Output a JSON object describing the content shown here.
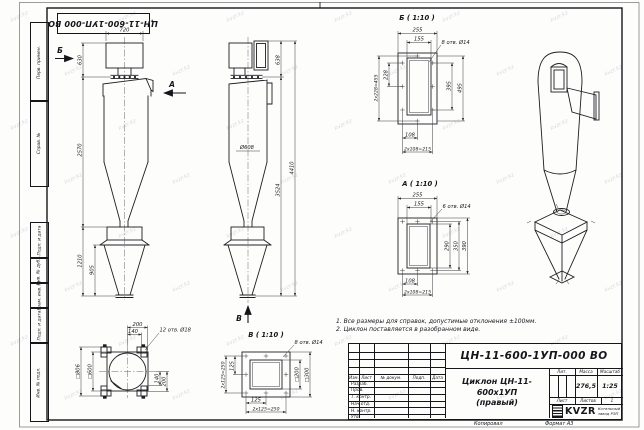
{
  "frame": {
    "inverted_title": "ЦН-11-600-1УП-000 ВО",
    "columns_top": [
      "Перв. примен.",
      "Справ. №"
    ],
    "columns_bottom": [
      "Подп. и дата",
      "Инв. № дубл.",
      "Взам. инв. №",
      "Подп. и дата",
      "Инв. № подл."
    ]
  },
  "notes": {
    "line1": "1. Все размеры для справок, допустимые отклонения ±100мм.",
    "line2": "2. Циклон поставляется в разобранном виде."
  },
  "views": {
    "front": {
      "d720": "720",
      "d630": "630",
      "d2570": "2570",
      "d1210": "1210",
      "d905": "905",
      "letter_b": "Б",
      "letter_a": "А"
    },
    "side": {
      "d638": "638",
      "d608": "Ø608",
      "d4410": "4410",
      "d3524": "3524",
      "letter_v": "В"
    },
    "detail_b": {
      "title": "Б ( 1:10 )",
      "holes": "8 отв. Ø14",
      "d255": "255",
      "d155": "155",
      "d228": "228",
      "d228c": "2х228=455",
      "d395": "395",
      "d495": "495",
      "d108": "108",
      "d108c": "2х108=215"
    },
    "detail_a": {
      "title": "А ( 1:10 )",
      "holes": "6 отв. Ø14",
      "d255": "255",
      "d155": "155",
      "d290": "290",
      "d350": "350",
      "d390": "390",
      "d108": "108",
      "d108c": "2х108=215"
    },
    "detail_v": {
      "title": "В ( 1:10 )",
      "holes": "8 отв. Ø14",
      "d125l": "125",
      "d250l": "2х125=250",
      "d200": "□200",
      "d300": "□300",
      "d125b": "125",
      "d250b": "2х125=250"
    },
    "top_view": {
      "holes": "12 отв. Ø18",
      "d200t": "200",
      "d140t": "140",
      "d140r": "140",
      "d200r": "200",
      "d806": "□806",
      "d600": "□600"
    }
  },
  "title_block": {
    "doc_number": "ЦН-11-600-1УП-000 ВО",
    "product_name": "Циклон ЦН-11-600х1УП",
    "product_variant": "(правый)",
    "header_cols": [
      "Изм.",
      "Лист",
      "№ докум.",
      "Подп.",
      "Дата"
    ],
    "sig_rows": [
      "Разраб.",
      "Пров.",
      "Т. контр.",
      "Нач.отд.",
      "Н. контр.",
      "Утв."
    ],
    "lit_label": "Лит.",
    "mass_label": "Масса",
    "scale_label": "Масштаб",
    "mass_value": "276,5",
    "scale_value": "1:25",
    "sheet_label": "Лист",
    "sheets_label": "Листов",
    "sheets_value": "1",
    "logo_text": "KVZR",
    "company_line1": "Котельный",
    "company_line2": "завод РЭП"
  },
  "footer": {
    "copied": "Копировал",
    "format": "Формат А3"
  },
  "watermark": {
    "text": "kvzr.kz"
  }
}
